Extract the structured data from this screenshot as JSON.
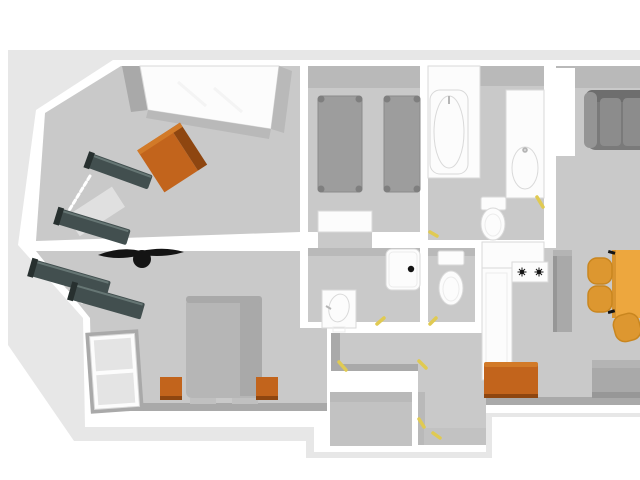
{
  "scene": {
    "description": "3D top-down rendering of an apartment floor plan, no text labels",
    "canvas": {
      "width": 640,
      "height": 480
    },
    "view": "overhead perspective, right side of plan cropped by image edge"
  },
  "colors": {
    "bg": "#ffffff",
    "ground": "#e7e7e7",
    "wall": "#ffffff",
    "floor": "#c9c9c9",
    "floor-dark": "#c2c2c2",
    "shade": "#b9b9b9",
    "face": "#a9a9a9",
    "fixture": "#fcfcfc",
    "fixture-line": "#d9d9d9",
    "fixture-inner": "#ececec",
    "metal": "#b5b5b5",
    "bunk": "#424f4f",
    "bunk-edge": "#667674",
    "bunk-dark": "#27302f",
    "orange": "#c2641c",
    "orange-light": "#d27a28",
    "orange-dark": "#8e4610",
    "bed-gray": "#9d9d9d",
    "bed-edge": "#8a8a8a",
    "bed-knob": "#7f7f7f",
    "double-bed": "#b6b6b6",
    "double-bed-shade": "#a9a9a9",
    "double-bed-foot": "#c0c0c0",
    "sofa": "#7a7a7a",
    "sofa-back": "#6e6e6e",
    "sofa-cushion": "#8c8c8c",
    "sofa-arm": "#959595",
    "amber": "#eda73e",
    "amber-dark": "#d89430",
    "chair": "#dd9730",
    "chair-edge": "#c9861f",
    "appliance": "#a9a9a9",
    "appliance-dark": "#979797",
    "appliance-light": "#b4b4b4",
    "black": "#141414",
    "yellow": "#e0ca52",
    "glass": "#e4e4e4",
    "window-light": "#e0e0e0",
    "streak": "#f1f1f1"
  },
  "rooms": [
    {
      "id": "bunk-bedroom",
      "label": "bedroom with two bunk beds, orange wardrobe and white built-in closet"
    },
    {
      "id": "master-bedroom",
      "label": "bedroom with double bed, two orange nightstands, two bunk beds, ceiling fan and window"
    },
    {
      "id": "twin-bedroom",
      "label": "bedroom with two single gray beds"
    },
    {
      "id": "bathroom",
      "label": "bathroom with bathtub, vanity sink and toilet"
    },
    {
      "id": "wc",
      "label": "separate toilet room"
    },
    {
      "id": "shower-room",
      "label": "shower room with shower tray and pedestal sink"
    },
    {
      "id": "kitchen",
      "label": "kitchen with white counters, two-burner stove and tall appliance"
    },
    {
      "id": "living-dining",
      "label": "living/dining area with gray sofa, amber table, three chairs, orange chest, gray bench"
    },
    {
      "id": "hallway",
      "label": "central hallway"
    },
    {
      "id": "storage",
      "label": "small storage room at the bottom"
    },
    {
      "id": "entry",
      "label": "entry corridor at the bottom"
    }
  ],
  "furniture": [
    {
      "name": "built-in-closet",
      "room": "bunk-bedroom"
    },
    {
      "name": "wardrobe-orange",
      "room": "bunk-bedroom"
    },
    {
      "name": "bunk-bed-1",
      "room": "bunk-bedroom"
    },
    {
      "name": "bunk-bed-2",
      "room": "bunk-bedroom"
    },
    {
      "name": "ceiling-fan",
      "room": "master-bedroom"
    },
    {
      "name": "bunk-bed-3",
      "room": "master-bedroom"
    },
    {
      "name": "bunk-bed-4",
      "room": "master-bedroom"
    },
    {
      "name": "double-bed",
      "room": "master-bedroom"
    },
    {
      "name": "nightstand-left",
      "room": "master-bedroom"
    },
    {
      "name": "nightstand-right",
      "room": "master-bedroom"
    },
    {
      "name": "window-door",
      "room": "master-bedroom"
    },
    {
      "name": "single-bed-1",
      "room": "twin-bedroom"
    },
    {
      "name": "single-bed-2",
      "room": "twin-bedroom"
    },
    {
      "name": "open-door-leaf",
      "room": "twin-bedroom"
    },
    {
      "name": "bathtub",
      "room": "bathroom"
    },
    {
      "name": "vanity-sink",
      "room": "bathroom"
    },
    {
      "name": "toilet",
      "room": "bathroom"
    },
    {
      "name": "toilet",
      "room": "wc"
    },
    {
      "name": "shower-tray",
      "room": "shower-room"
    },
    {
      "name": "pedestal-sink",
      "room": "shower-room"
    },
    {
      "name": "counter",
      "room": "kitchen"
    },
    {
      "name": "base-cabinet",
      "room": "kitchen"
    },
    {
      "name": "stove-two-burners",
      "room": "kitchen"
    },
    {
      "name": "fridge",
      "room": "kitchen"
    },
    {
      "name": "sofa",
      "room": "living-dining"
    },
    {
      "name": "dining-table",
      "room": "living-dining"
    },
    {
      "name": "chair-1",
      "room": "living-dining"
    },
    {
      "name": "chair-2",
      "room": "living-dining"
    },
    {
      "name": "chair-3",
      "room": "living-dining"
    },
    {
      "name": "chest-orange",
      "room": "hallway"
    },
    {
      "name": "bench-gray",
      "room": "living-dining"
    }
  ],
  "markers": {
    "door_handle_count": 8,
    "door_handle_color": "#e0ca52"
  }
}
